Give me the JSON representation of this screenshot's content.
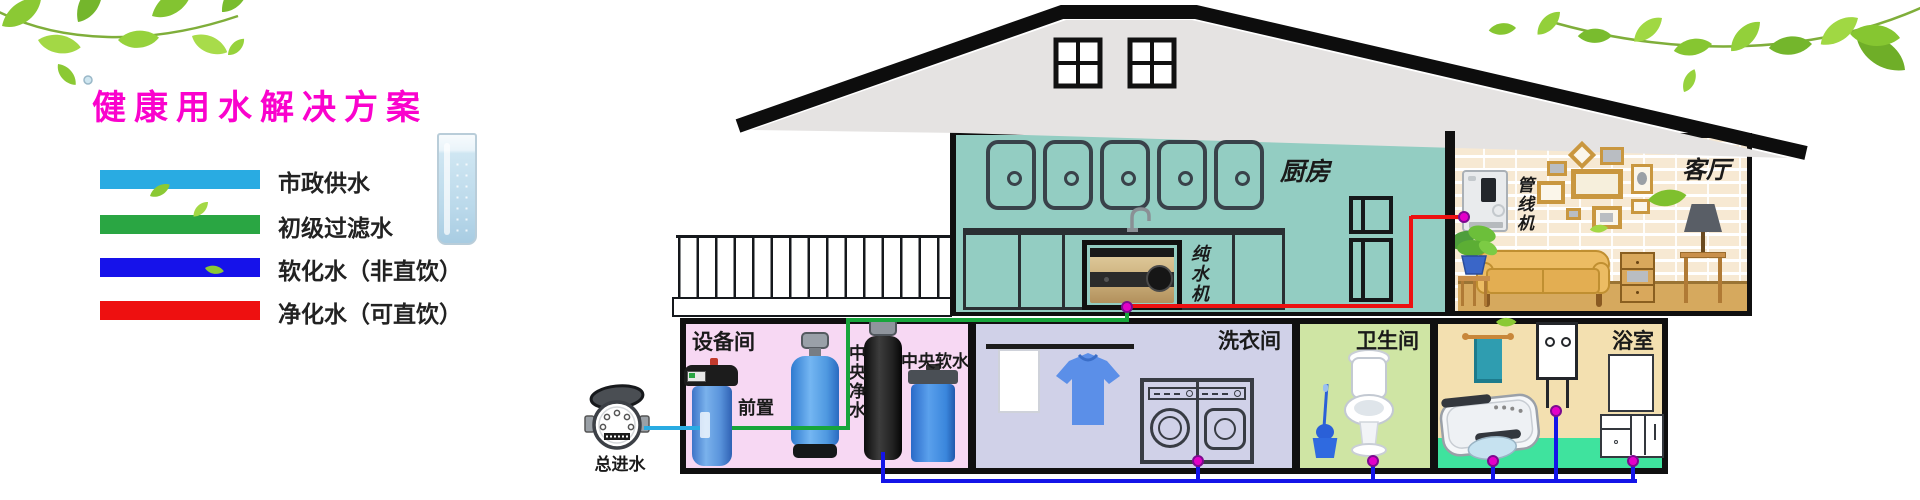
{
  "title": {
    "text": "健康用水解决方案",
    "color": "#fa02cd"
  },
  "legend": {
    "items": [
      {
        "label": "市政供水",
        "color": "#29abe2"
      },
      {
        "label": "初级过滤水",
        "color": "#2aa643"
      },
      {
        "label": "软化水（非直饮）",
        "color": "#1612ea"
      },
      {
        "label": "净化水（可直饮）",
        "color": "#ee1010"
      }
    ]
  },
  "pipes": {
    "municipal_color": "#29abe2",
    "filtered_color": "#17a53b",
    "softened_color": "#1414e8",
    "purified_color": "#ec1111",
    "junction_dot_color": "#e400c8"
  },
  "rooms": {
    "kitchen": "厨房",
    "living_room": "客厅",
    "equipment_room": "设备间",
    "laundry_room": "洗衣间",
    "toilet_room": "卫生间",
    "bathroom": "浴室"
  },
  "devices": {
    "main_inlet": "总进水",
    "prefilter": "前置",
    "central_purifier": "中央净水",
    "central_softener": "中央软水",
    "pure_water_machine": "纯水机",
    "pipeline_machine": "管线机"
  }
}
